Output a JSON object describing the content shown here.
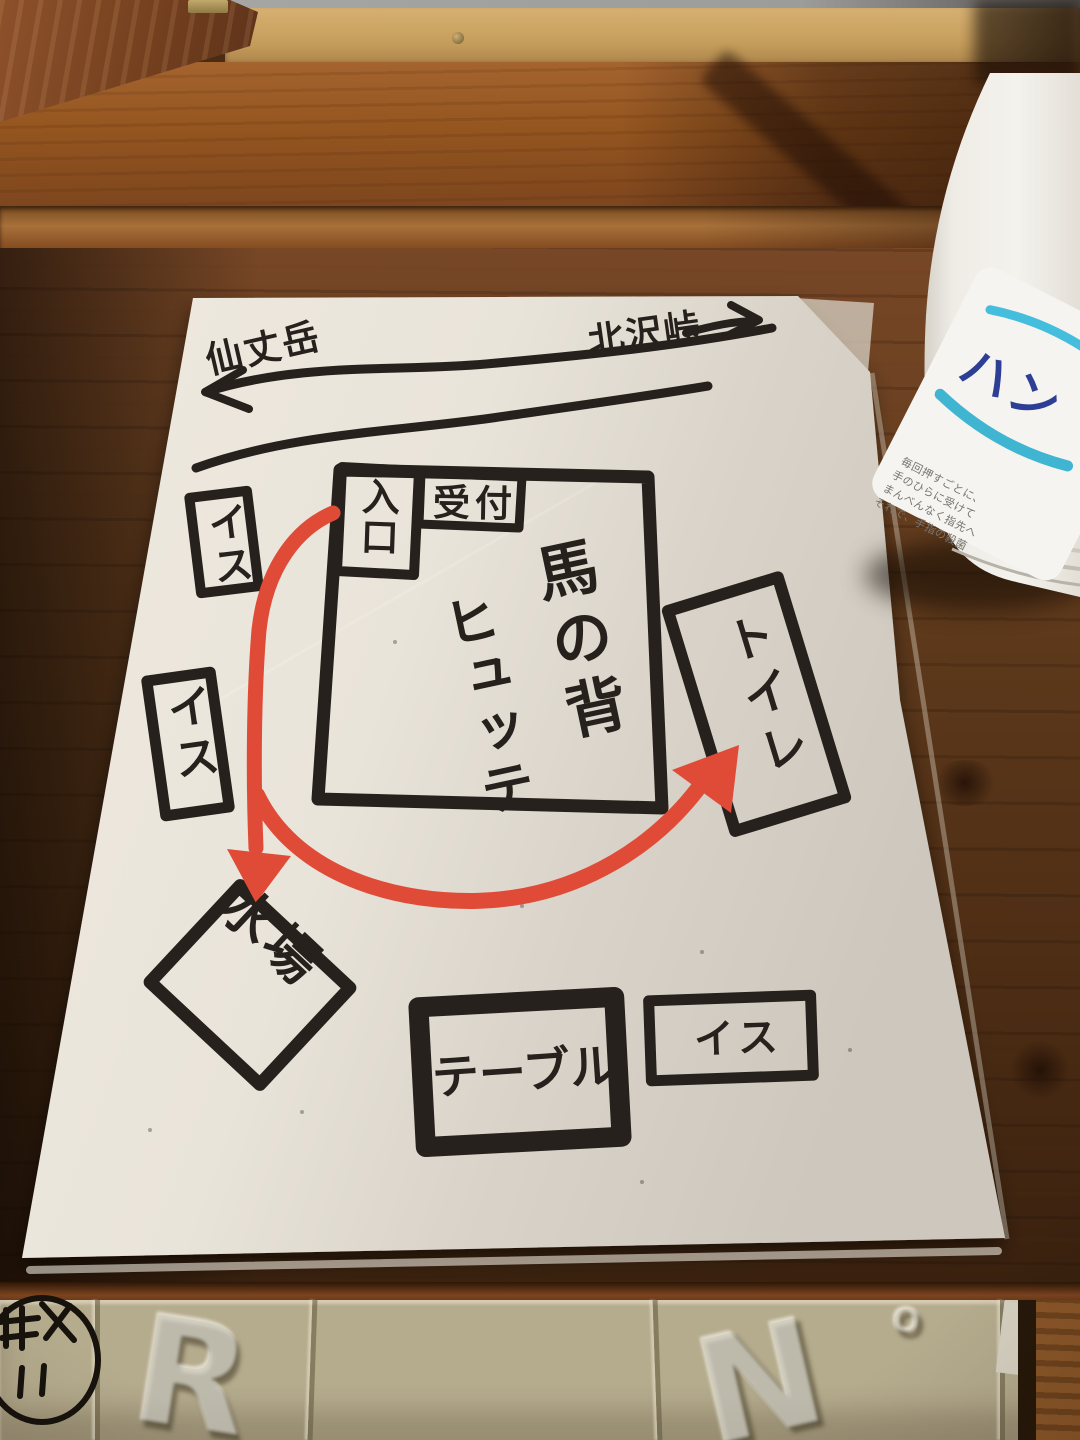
{
  "map": {
    "trail": {
      "left_label": "仙丈岳",
      "right_label": "北沢峠"
    },
    "building": {
      "entrance": "入口",
      "reception": "受付",
      "name_col_right": "馬の背",
      "name_col_left": "ヒュッテ",
      "full_name": "馬の背ヒュッテ"
    },
    "features": {
      "chair_upper_left": "イス",
      "chair_lower_left": "イス",
      "toilet": "トイレ",
      "water_place": "水場",
      "table": "テーブル",
      "chair_bottom_right": "イス"
    },
    "route_color": "#e04b38",
    "ink_color": "#26211c",
    "paper_color": "#e9e4da"
  },
  "bottle": {
    "brand_text": "ハン",
    "brand_text_color": "#2d3f94",
    "accent_color": "#45bedd",
    "instructions": [
      "毎回押すごとに、",
      "手のひらに受けて",
      "まんべんなく指先へ",
      "それで、手指の殺菌"
    ]
  },
  "blocks": {
    "embossed_letters": [
      "R",
      "N",
      "O"
    ]
  }
}
